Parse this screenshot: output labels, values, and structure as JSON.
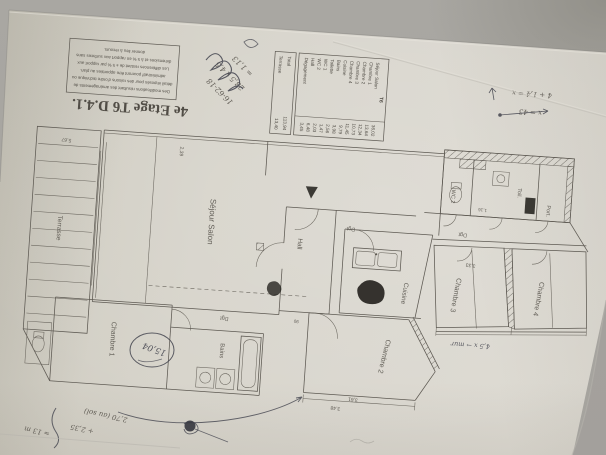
{
  "colors": {
    "background": "#a7a5a0",
    "paper": "#d7d4cc",
    "ink": "#5d5952",
    "pen_handwriting": "#42434d",
    "marker_blob": "#26241f"
  },
  "title": "4e Etage T6 D.4.1.",
  "disclaimer": {
    "lines": [
      "Des modifications résultant des aménagements de",
      "détail imposés pour des raisons d'ordre technique ou",
      "administratif pourront être apportées au plan.",
      "Les différences restant de ± 5 % par rapport aux",
      "dimensions et à 5 % en rapport aux surfaces sans",
      "donner lieu à recours."
    ]
  },
  "schedule": {
    "header": "T6",
    "rows": [
      {
        "label": "Séjour Salon",
        "area": "36,02"
      },
      {
        "label": "Chambre 1",
        "area": "13,64"
      },
      {
        "label": "Chambre 2",
        "area": "12,34"
      },
      {
        "label": "Chambre 3",
        "area": "10,73"
      },
      {
        "label": "Chambre 4",
        "area": "11,45"
      },
      {
        "label": "Cuisine",
        "area": "9,79"
      },
      {
        "label": "Bains",
        "area": "3,98"
      },
      {
        "label": "Toilette",
        "area": "2,56"
      },
      {
        "label": "WC 1",
        "area": "1,47"
      },
      {
        "label": "WC 2",
        "area": "2,03"
      },
      {
        "label": "Hall",
        "area": "6,48"
      },
      {
        "label": "Dégagement",
        "area": "3,45"
      }
    ],
    "total": {
      "label": "Total",
      "value": "113,94"
    },
    "terrasse": {
      "label": "Terrasse",
      "value": "13,40"
    }
  },
  "rooms": {
    "terrasse": "Terrasse",
    "sejour": "Séjour  Salon",
    "chambre1": "Chambre 1",
    "chambre2": "Chambre 2",
    "chambre3": "Chambre 3",
    "chambre4": "Chambre 4",
    "cuisine": "Cuisine",
    "bains": "Bains",
    "hall": "Hall",
    "dgt1": "Dgt",
    "dgt2": "Dgt",
    "dgt3": "Dgt",
    "wc2": "WC 2",
    "toil": "Toil.",
    "port": "Port."
  },
  "dims": {
    "terrasse_w": "5,67",
    "sejour_h": "2,39",
    "chambre3_w": "3,33",
    "chambre2_w": "3,61",
    "chambre2_w2": "3,48",
    "wc_w": "1,16",
    "door_w": "90"
  },
  "annotations": {
    "calc1": "16-62-18",
    "calc2": "28,5 x 4,5",
    "calc3": "= 1,13",
    "xnote1": "4 + 1,4 = x",
    "xnote2": "x = 43",
    "floor1": "2,70 (au sol)",
    "floor2": "+ 2,35",
    "floor3": "≈ 13 m",
    "mur_note": "4,5 x → mur",
    "circled_note": "15,04"
  }
}
